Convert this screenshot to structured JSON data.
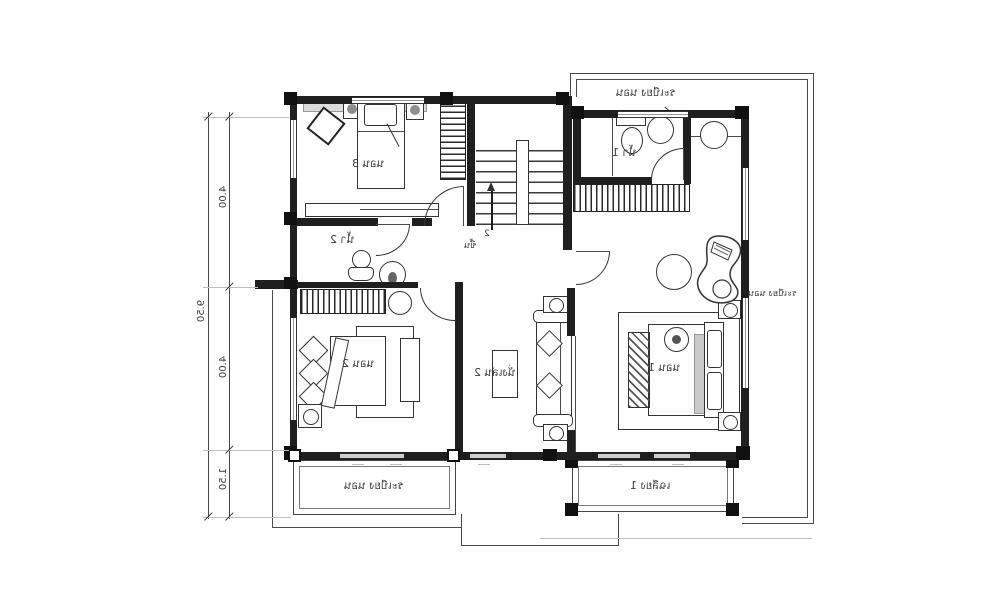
{
  "labels": {
    "bedroom3": "นอน 3",
    "bedroom2": "นอน 2",
    "bedroom1": "นอน 1",
    "bathroom1": "น้ำ 1",
    "bathroom2": "น้ำ 2",
    "living2": "นั่งเล่น 2",
    "stair_direction": "ขึ้น",
    "stair_number": "2",
    "balcony_top": "ระเบียง นอน",
    "balcony_right": "ระเบียง นอน",
    "balcony_bottom_left": "ระเบียง นอน",
    "porch_bottom_right": "เฉลียง 1"
  },
  "dimensions": {
    "overall": "9.50",
    "segment_top": "4.00",
    "segment_middle": "4.00",
    "segment_bottom": "1.50"
  },
  "colors": {
    "walls": "#1f1f1f",
    "thin_lines": "#4a4a4a",
    "shading": "#d9d9d9",
    "background": "#ffffff"
  }
}
